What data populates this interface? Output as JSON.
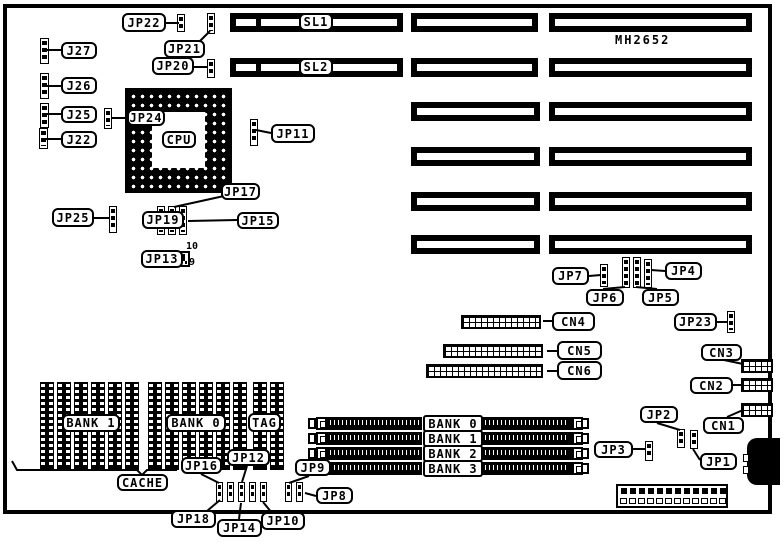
{
  "board": {
    "model_text": "MH2652"
  },
  "expansion_slots": {
    "rows": [
      {
        "y": 13,
        "segments": [
          {
            "x": 230,
            "w": 173,
            "divider": true
          },
          {
            "x": 411,
            "w": 127
          },
          {
            "x": 549,
            "w": 203
          }
        ]
      },
      {
        "y": 58,
        "segments": [
          {
            "x": 230,
            "w": 173,
            "divider": true
          },
          {
            "x": 411,
            "w": 127
          },
          {
            "x": 549,
            "w": 203
          }
        ]
      },
      {
        "y": 102,
        "segments": [
          {
            "x": 411,
            "w": 129
          },
          {
            "x": 549,
            "w": 203
          }
        ]
      },
      {
        "y": 147,
        "segments": [
          {
            "x": 411,
            "w": 129
          },
          {
            "x": 549,
            "w": 203
          }
        ]
      },
      {
        "y": 192,
        "segments": [
          {
            "x": 411,
            "w": 129
          },
          {
            "x": 549,
            "w": 203
          }
        ]
      },
      {
        "y": 235,
        "segments": [
          {
            "x": 411,
            "w": 129
          },
          {
            "x": 549,
            "w": 203
          }
        ]
      }
    ]
  },
  "cache_block": {
    "x_list": [
      40,
      57,
      74,
      91,
      108,
      125,
      148,
      165,
      182,
      199,
      216,
      233,
      253,
      270
    ],
    "y": 382,
    "col_w": 14,
    "col_h": 88,
    "bracket": "12,461 17,470 137,470 142,475 147,470 177,470"
  },
  "simm_banks": {
    "rows": [
      {
        "label": "BANK 0",
        "y": 417
      },
      {
        "label": "BANK 1",
        "y": 432
      },
      {
        "label": "BANK 2",
        "y": 447
      },
      {
        "label": "BANK 3",
        "y": 462
      }
    ],
    "bar1": {
      "x": 327,
      "w": 95
    },
    "bar2": {
      "x": 482,
      "w": 90
    },
    "clip_l": 316,
    "clip_r": 572,
    "cap_l": 308,
    "cap_r": 581,
    "label_x": 423,
    "label_w": 60
  },
  "pin_headers": [
    {
      "id": "cn4",
      "x": 461,
      "y": 315,
      "w": 80,
      "h": 14
    },
    {
      "id": "cn5",
      "x": 443,
      "y": 344,
      "w": 100,
      "h": 14
    },
    {
      "id": "cn6",
      "x": 426,
      "y": 364,
      "w": 117,
      "h": 14
    },
    {
      "id": "cn3",
      "x": 741,
      "y": 359,
      "w": 32,
      "h": 14
    },
    {
      "id": "cn2",
      "x": 741,
      "y": 378,
      "w": 32,
      "h": 14
    },
    {
      "id": "cn1",
      "x": 741,
      "y": 403,
      "w": 32,
      "h": 14
    }
  ],
  "jumper_strips": [
    {
      "id": "j27",
      "x": 40,
      "y": 38,
      "w": 9,
      "h": 26
    },
    {
      "id": "j26",
      "x": 40,
      "y": 73,
      "w": 9,
      "h": 26
    },
    {
      "id": "j25",
      "x": 40,
      "y": 103,
      "w": 9,
      "h": 25
    },
    {
      "id": "j22",
      "x": 39,
      "y": 128,
      "w": 9,
      "h": 21
    },
    {
      "id": "jp22",
      "x": 177,
      "y": 14,
      "w": 8,
      "h": 18
    },
    {
      "id": "jp21",
      "x": 207,
      "y": 13,
      "w": 8,
      "h": 21
    },
    {
      "id": "jp20",
      "x": 207,
      "y": 59,
      "w": 8,
      "h": 19
    },
    {
      "id": "jp24",
      "x": 104,
      "y": 108,
      "w": 8,
      "h": 21
    },
    {
      "id": "jp11",
      "x": 250,
      "y": 119,
      "w": 8,
      "h": 27
    },
    {
      "id": "jp25",
      "x": 109,
      "y": 206,
      "w": 8,
      "h": 27
    },
    {
      "id": "jp19-col1",
      "x": 157,
      "y": 206,
      "w": 8,
      "h": 29
    },
    {
      "id": "jp17-col2",
      "x": 168,
      "y": 206,
      "w": 8,
      "h": 29
    },
    {
      "id": "jp15-col3",
      "x": 179,
      "y": 206,
      "w": 8,
      "h": 29
    },
    {
      "id": "jp7",
      "x": 600,
      "y": 264,
      "w": 8,
      "h": 23
    },
    {
      "id": "jp6",
      "x": 622,
      "y": 257,
      "w": 8,
      "h": 31
    },
    {
      "id": "jp5",
      "x": 633,
      "y": 257,
      "w": 8,
      "h": 31
    },
    {
      "id": "jp4",
      "x": 644,
      "y": 259,
      "w": 8,
      "h": 29
    },
    {
      "id": "jp23",
      "x": 727,
      "y": 311,
      "w": 8,
      "h": 22
    },
    {
      "id": "jp2",
      "x": 677,
      "y": 429,
      "w": 8,
      "h": 19
    },
    {
      "id": "jp1",
      "x": 690,
      "y": 430,
      "w": 8,
      "h": 19
    },
    {
      "id": "jp3",
      "x": 645,
      "y": 441,
      "w": 8,
      "h": 20
    },
    {
      "id": "jp18-t",
      "x": 216,
      "y": 482,
      "w": 7,
      "h": 20
    },
    {
      "id": "jp16-t",
      "x": 227,
      "y": 482,
      "w": 7,
      "h": 20
    },
    {
      "id": "jp14-t",
      "x": 238,
      "y": 482,
      "w": 7,
      "h": 20
    },
    {
      "id": "jp12-t",
      "x": 249,
      "y": 482,
      "w": 7,
      "h": 20
    },
    {
      "id": "jp10-t",
      "x": 260,
      "y": 482,
      "w": 7,
      "h": 20
    },
    {
      "id": "jp9-t",
      "x": 285,
      "y": 482,
      "w": 7,
      "h": 20
    },
    {
      "id": "jp8-t",
      "x": 296,
      "y": 482,
      "w": 7,
      "h": 20
    }
  ],
  "jp13_block": {
    "x": 156,
    "y": 251,
    "w": 34,
    "h": 16
  },
  "pin_numbers": [
    {
      "text": "10",
      "x": 186,
      "y": 241
    },
    {
      "text": "9",
      "x": 189,
      "y": 257
    }
  ],
  "callouts": [
    {
      "id": "j27",
      "text": "J27",
      "x": 61,
      "y": 42,
      "w": 36,
      "h": 17
    },
    {
      "id": "j26",
      "text": "J26",
      "x": 61,
      "y": 77,
      "w": 36,
      "h": 17
    },
    {
      "id": "j25",
      "text": "J25",
      "x": 61,
      "y": 106,
      "w": 36,
      "h": 17
    },
    {
      "id": "j22",
      "text": "J22",
      "x": 61,
      "y": 131,
      "w": 36,
      "h": 17
    },
    {
      "id": "jp22",
      "text": "JP22",
      "x": 122,
      "y": 13,
      "w": 44,
      "h": 19
    },
    {
      "id": "jp21",
      "text": "JP21",
      "x": 164,
      "y": 40,
      "w": 41,
      "h": 18
    },
    {
      "id": "jp20",
      "text": "JP20",
      "x": 152,
      "y": 57,
      "w": 42,
      "h": 18
    },
    {
      "id": "jp24",
      "text": "JP24",
      "x": 127,
      "y": 109,
      "w": 38,
      "h": 17
    },
    {
      "id": "jp11",
      "text": "JP11",
      "x": 271,
      "y": 124,
      "w": 44,
      "h": 19
    },
    {
      "id": "jp17",
      "text": "JP17",
      "x": 221,
      "y": 183,
      "w": 39,
      "h": 17
    },
    {
      "id": "jp25",
      "text": "JP25",
      "x": 52,
      "y": 208,
      "w": 42,
      "h": 19
    },
    {
      "id": "jp19",
      "text": "JP19",
      "x": 142,
      "y": 211,
      "w": 42,
      "h": 18
    },
    {
      "id": "jp15",
      "text": "JP15",
      "x": 237,
      "y": 212,
      "w": 42,
      "h": 17
    },
    {
      "id": "jp13",
      "text": "JP13",
      "x": 141,
      "y": 250,
      "w": 42,
      "h": 18
    },
    {
      "id": "sl1",
      "text": "SL1",
      "x": 299,
      "y": 13,
      "w": 34,
      "h": 18
    },
    {
      "id": "sl2",
      "text": "SL2",
      "x": 299,
      "y": 58,
      "w": 34,
      "h": 18
    },
    {
      "id": "cpu",
      "text": "CPU",
      "x": 162,
      "y": 131,
      "w": 34,
      "h": 17
    },
    {
      "id": "jp7",
      "text": "JP7",
      "x": 552,
      "y": 267,
      "w": 37,
      "h": 18
    },
    {
      "id": "jp6",
      "text": "JP6",
      "x": 586,
      "y": 289,
      "w": 38,
      "h": 17
    },
    {
      "id": "jp5",
      "text": "JP5",
      "x": 642,
      "y": 289,
      "w": 37,
      "h": 17
    },
    {
      "id": "jp4",
      "text": "JP4",
      "x": 665,
      "y": 262,
      "w": 37,
      "h": 18
    },
    {
      "id": "jp23",
      "text": "JP23",
      "x": 674,
      "y": 313,
      "w": 43,
      "h": 18
    },
    {
      "id": "cn4",
      "text": "CN4",
      "x": 552,
      "y": 312,
      "w": 43,
      "h": 19
    },
    {
      "id": "cn5",
      "text": "CN5",
      "x": 557,
      "y": 341,
      "w": 45,
      "h": 19
    },
    {
      "id": "cn6",
      "text": "CN6",
      "x": 557,
      "y": 361,
      "w": 45,
      "h": 19
    },
    {
      "id": "cn3",
      "text": "CN3",
      "x": 701,
      "y": 344,
      "w": 41,
      "h": 17
    },
    {
      "id": "cn2",
      "text": "CN2",
      "x": 690,
      "y": 377,
      "w": 43,
      "h": 17
    },
    {
      "id": "cn1",
      "text": "CN1",
      "x": 703,
      "y": 417,
      "w": 41,
      "h": 17
    },
    {
      "id": "jp2",
      "text": "JP2",
      "x": 640,
      "y": 406,
      "w": 38,
      "h": 17
    },
    {
      "id": "jp3",
      "text": "JP3",
      "x": 594,
      "y": 441,
      "w": 39,
      "h": 17
    },
    {
      "id": "jp1",
      "text": "JP1",
      "x": 700,
      "y": 453,
      "w": 37,
      "h": 17
    },
    {
      "id": "bank1-cache",
      "text": "BANK 1",
      "x": 62,
      "y": 414,
      "w": 58,
      "h": 18
    },
    {
      "id": "bank0-cache",
      "text": "BANK 0",
      "x": 166,
      "y": 414,
      "w": 60,
      "h": 18
    },
    {
      "id": "tag",
      "text": "TAG",
      "x": 248,
      "y": 413,
      "w": 33,
      "h": 19
    },
    {
      "id": "cache",
      "text": "CACHE",
      "x": 117,
      "y": 474,
      "w": 51,
      "h": 17
    },
    {
      "id": "jp16",
      "text": "JP16",
      "x": 181,
      "y": 457,
      "w": 41,
      "h": 17
    },
    {
      "id": "jp12",
      "text": "JP12",
      "x": 227,
      "y": 449,
      "w": 43,
      "h": 17
    },
    {
      "id": "jp18",
      "text": "JP18",
      "x": 171,
      "y": 510,
      "w": 45,
      "h": 18
    },
    {
      "id": "jp14",
      "text": "JP14",
      "x": 217,
      "y": 519,
      "w": 45,
      "h": 18
    },
    {
      "id": "jp10",
      "text": "JP10",
      "x": 261,
      "y": 512,
      "w": 44,
      "h": 18
    },
    {
      "id": "jp9",
      "text": "JP9",
      "x": 295,
      "y": 459,
      "w": 36,
      "h": 17
    },
    {
      "id": "jp8",
      "text": "JP8",
      "x": 316,
      "y": 487,
      "w": 37,
      "h": 17
    }
  ],
  "leader_lines": [
    [
      61,
      50,
      46,
      50
    ],
    [
      61,
      86,
      46,
      86
    ],
    [
      61,
      114,
      46,
      114
    ],
    [
      61,
      139,
      45,
      139
    ],
    [
      166,
      23,
      179,
      23
    ],
    [
      200,
      41,
      210,
      31
    ],
    [
      194,
      67,
      208,
      67
    ],
    [
      131,
      118,
      111,
      118
    ],
    [
      271,
      133,
      256,
      130
    ],
    [
      224,
      196,
      174,
      207
    ],
    [
      94,
      218,
      110,
      218
    ],
    [
      184,
      220,
      160,
      220
    ],
    [
      237,
      220,
      188,
      221
    ],
    [
      183,
      259,
      159,
      259
    ],
    [
      589,
      276,
      601,
      275
    ],
    [
      603,
      289,
      625,
      287
    ],
    [
      657,
      289,
      636,
      287
    ],
    [
      665,
      271,
      651,
      270
    ],
    [
      716,
      322,
      728,
      322
    ],
    [
      552,
      321,
      543,
      321
    ],
    [
      557,
      351,
      547,
      351
    ],
    [
      557,
      371,
      547,
      371
    ],
    [
      724,
      360,
      743,
      364
    ],
    [
      732,
      385,
      742,
      385
    ],
    [
      727,
      417,
      743,
      410
    ],
    [
      657,
      423,
      680,
      430
    ],
    [
      700,
      460,
      693,
      449
    ],
    [
      632,
      449,
      646,
      449
    ],
    [
      201,
      474,
      219,
      483
    ],
    [
      247,
      466,
      242,
      482
    ],
    [
      207,
      511,
      220,
      500
    ],
    [
      239,
      519,
      241,
      503
    ],
    [
      272,
      513,
      263,
      502
    ],
    [
      309,
      476,
      289,
      483
    ],
    [
      316,
      496,
      305,
      493
    ]
  ],
  "power_connector": {
    "x": 616,
    "y": 484,
    "w": 112,
    "h": 24,
    "pins": 12
  },
  "keyboard_connector": {
    "x": 747,
    "y": 438,
    "w": 33,
    "h": 47,
    "tab_ys": [
      454,
      466
    ]
  }
}
